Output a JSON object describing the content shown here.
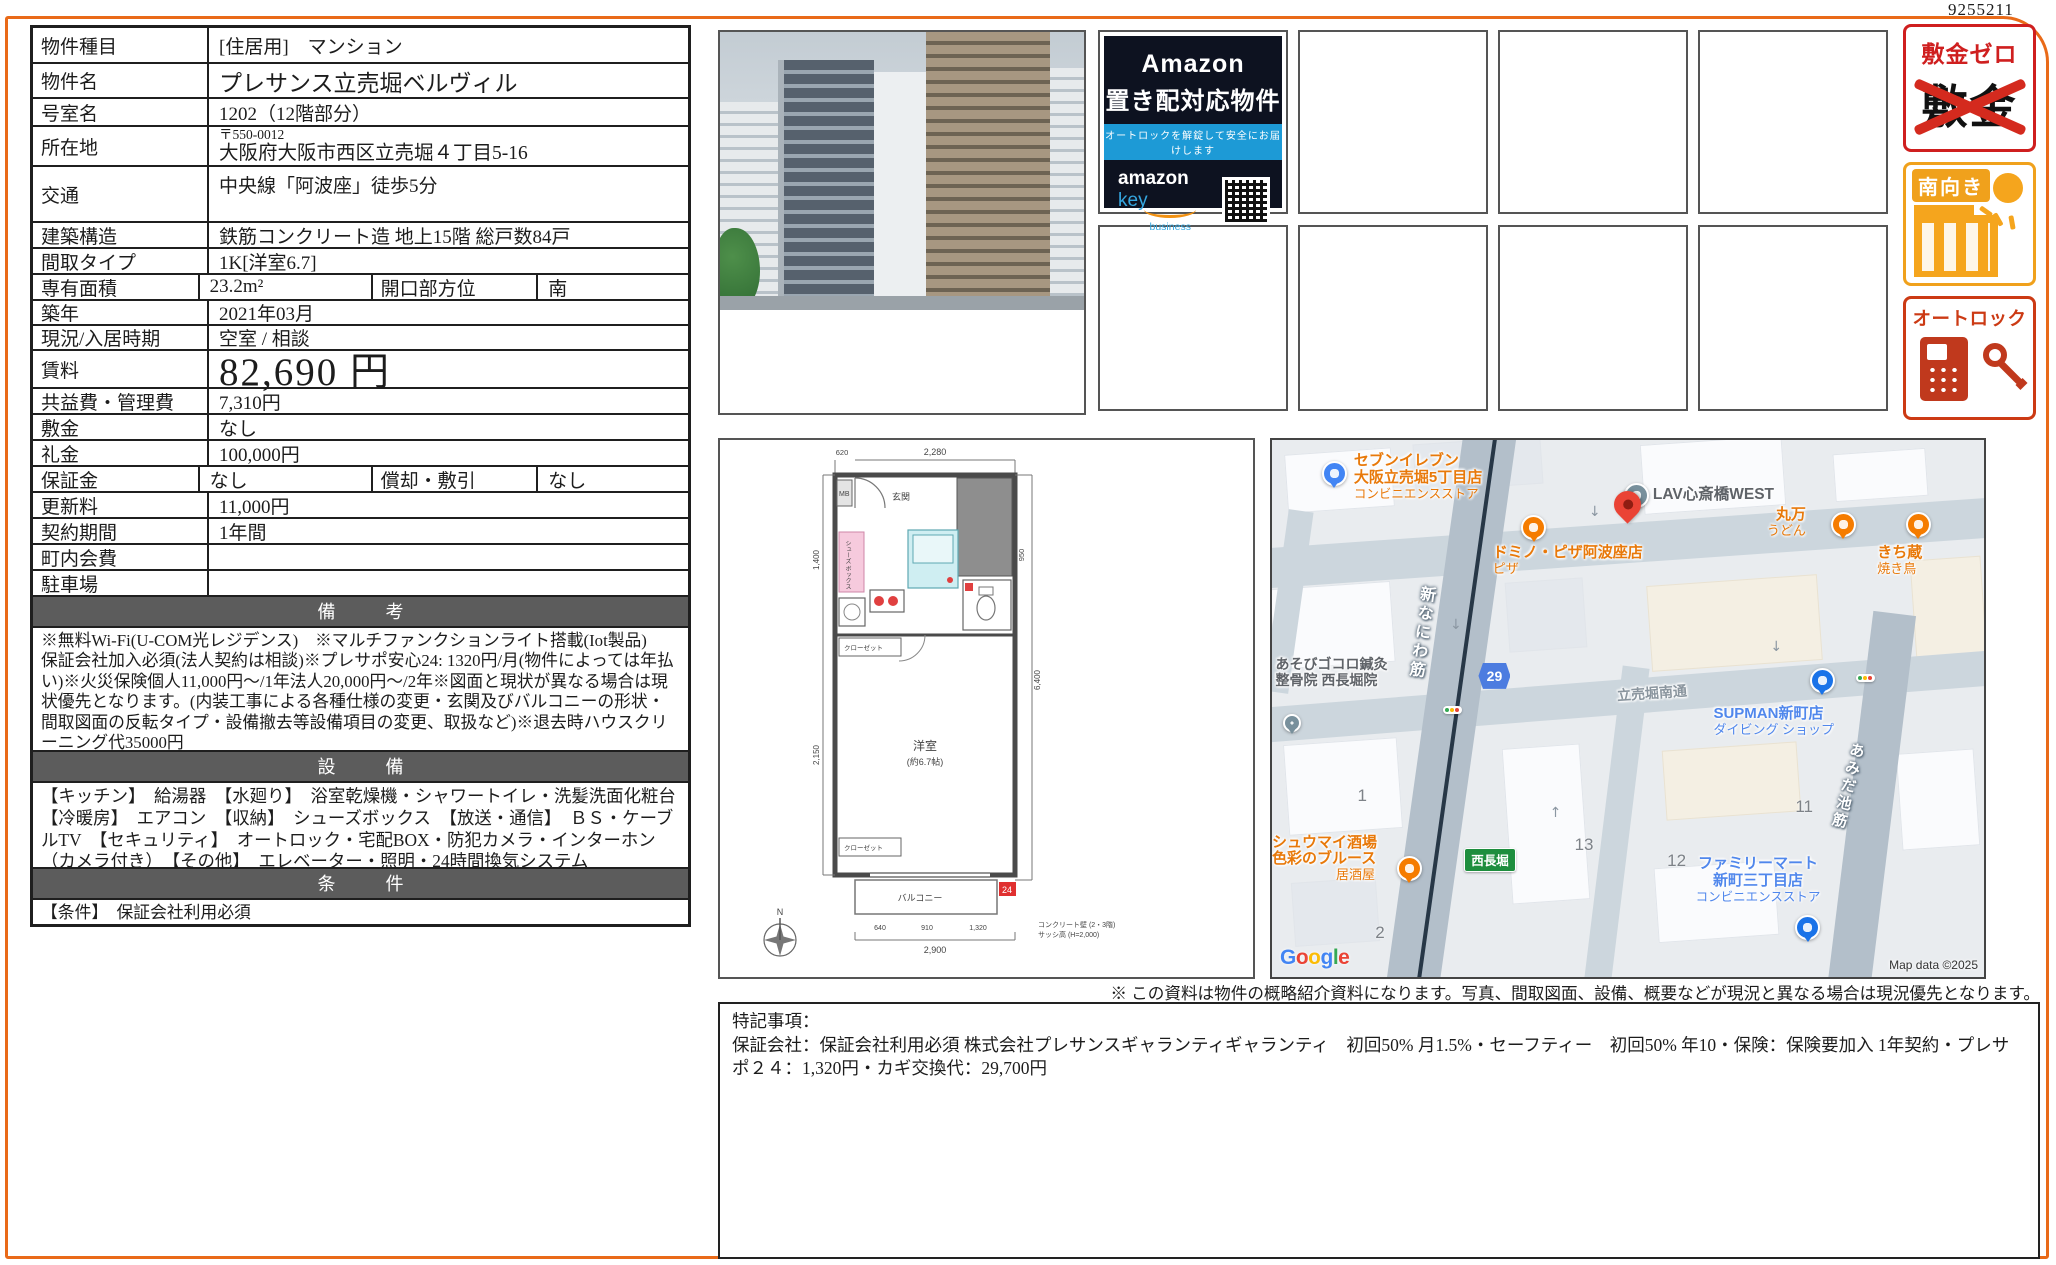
{
  "doc_number": "9255211",
  "table": {
    "rows": [
      {
        "label": "物件種目",
        "value": "[住居用]　マンション"
      },
      {
        "label": "物件名",
        "value": "プレサンス立売堀ベルヴィル"
      },
      {
        "label": "号室名",
        "value": "1202（12階部分）"
      },
      {
        "label": "所在地",
        "zip": "〒550-0012",
        "value": "大阪府大阪市西区立売堀４丁目5-16"
      },
      {
        "label": "交通",
        "value": "中央線「阿波座」徒歩5分"
      },
      {
        "label": "建築構造",
        "value": "鉄筋コンクリート造 地上15階 総戸数84戸"
      },
      {
        "label": "間取タイプ",
        "value": "1K[洋室6.7]"
      },
      {
        "label": "専有面積",
        "value": "23.2m²",
        "label2": "開口部方位",
        "value2": "南"
      },
      {
        "label": "築年",
        "value": "2021年03月"
      },
      {
        "label": "現況/入居時期",
        "value": "空室 /  相談"
      },
      {
        "label": "賃料",
        "value": "82,690 円"
      },
      {
        "label": "共益費・管理費",
        "value": "7,310円"
      },
      {
        "label": "敷金",
        "value": "なし"
      },
      {
        "label": "礼金",
        "value": "100,000円"
      },
      {
        "label": "保証金",
        "value": "なし",
        "label2": "償却・敷引",
        "value2": "なし"
      },
      {
        "label": "更新料",
        "value": "11,000円"
      },
      {
        "label": "契約期間",
        "value": "1年間"
      },
      {
        "label": "町内会費",
        "value": ""
      },
      {
        "label": "駐車場",
        "value": ""
      }
    ],
    "remarks_title": "備　考",
    "remarks_line1": "※無料Wi-Fi(U-COM光レジデンス)　※マルチファンクションライト搭載(Iot製品)",
    "remarks_line2": "保証会社加入必須(法人契約は相談)※プレサポ安心24: 1320円/月(物件によっては年払い)※火災保険個人11,000円〜/1年法人20,000円〜/2年※図面と現状が異なる場合は現状優先となります。(内装工事による各種仕様の変更・玄関及びバルコニーの形状・間取図面の反転タイプ・設備撤去等設備項目の変更、取扱など)※退去時ハウスクリーニング代35000円",
    "equipment_title": "設　備",
    "equipment_text": "【キッチン】　給湯器　【水廻り】　浴室乾燥機・シャワートイレ・洗髪洗面化粧台　【冷暖房】　エアコン　【収納】　シューズボックス　【放送・通信】　ＢＳ・ケーブルTV　【セキュリティ】　オートロック・宅配BOX・防犯カメラ・インターホン（カメラ付き）　【その他】　エレベーター・照明・24時間換気システム",
    "conditions_title": "条　件",
    "conditions_text": "【条件】　保証会社利用必須"
  },
  "amazon_badge": {
    "line1": "Amazon",
    "line2": "置き配対応物件",
    "strip": "オートロックを解錠して安全にお届けします",
    "brand_left": "amazon",
    "brand_right": " key",
    "brand_sub": "business",
    "url": "www.amazon.co.jp/keyforbusiness"
  },
  "side_badges": {
    "deposit_zero_title": "敷金ゼロ",
    "deposit_crossed_word": "敷金",
    "south_facing_title": "南向き",
    "autolock_title": "オートロック"
  },
  "floorplan": {
    "entrance": "玄関",
    "mb": "MB",
    "shoebox": "シューズ ボックス",
    "room": "洋室",
    "room_size": "(約6.7帖)",
    "closet": "クローゼット",
    "closet2": "クローゼット",
    "balcony": "バルコニー",
    "marker": "24",
    "north": "N",
    "dim_top": "2,280",
    "dim_top_left": "620",
    "dim_left1": "1,400",
    "dim_left2": "2,150",
    "dim_right_inner": "950",
    "dim_right_outer": "6,400",
    "dim_bottom": "2,900",
    "dim_b1": "640",
    "dim_b2": "910",
    "dim_b3": "1,320",
    "note1": "コンクリート壁 (2・3階)",
    "note2": "サッシ高 (H=2,000)"
  },
  "map": {
    "pois": [
      {
        "name": "セブンイレブン",
        "sub": "大阪立売堀5丁目店",
        "sub2": "コンビニエンスストア"
      },
      {
        "name": "LAV心斎橋WEST"
      },
      {
        "name": "ドミノ・ピザ阿波座店",
        "sub": "ピザ"
      },
      {
        "name": "丸万",
        "sub": "うどん"
      },
      {
        "name": "きち蔵",
        "sub": "焼き鳥"
      },
      {
        "name": "あそびゴコロ鍼灸",
        "sub": "整骨院 西長堀院"
      },
      {
        "name": "シュウマイ酒場",
        "sub": "色彩のブルース",
        "sub2": "居酒屋"
      },
      {
        "name": "SUPMAN新町店",
        "sub": "ダイビング ショップ"
      },
      {
        "name": "ファミリーマート",
        "sub": "新町三丁目店",
        "sub2": "コンビニエンスストア"
      }
    ],
    "street_naniwa": "新なにわ筋",
    "street_itachibori": "立売堀南通",
    "street_amida": "あみだ池筋",
    "station": "西長堀",
    "route": "29",
    "parcels": [
      "1",
      "2",
      "13",
      "11",
      "12"
    ],
    "google_letters": [
      "G",
      "o",
      "o",
      "g",
      "l",
      "e"
    ],
    "copyright": "Map data ©2025"
  },
  "disclaimer": "※ この資料は物件の概略紹介資料になります。写真、間取図面、設備、概要などが現況と異なる場合は現況優先となります。",
  "notes": {
    "title": "特記事項：",
    "body": "保証会社：保証会社利用必須 株式会社プレサンスギャランティギャランティ　初回50% 月1.5%・セーフティー　初回50% 年10・保険：保険要加入 1年契約・プレサポ２４：1,320円・カギ交換代：29,700円"
  }
}
